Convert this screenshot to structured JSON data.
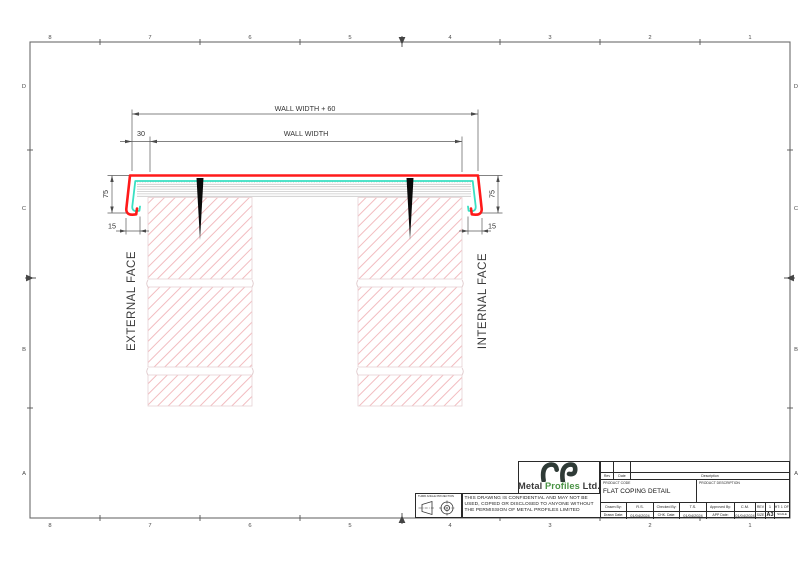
{
  "sheet": {
    "cols": [
      "8",
      "7",
      "6",
      "5",
      "4",
      "3",
      "2",
      "1"
    ],
    "rows": [
      "D",
      "C",
      "B",
      "A"
    ]
  },
  "drawing": {
    "dim_overall": "WALL WIDTH + 60",
    "dim_wall": "WALL WIDTH",
    "dim_overhang": "30",
    "dim_face_left": "75",
    "dim_face_right": "75",
    "dim_kick_left": "15",
    "dim_kick_right": "15",
    "label_external": "EXTERNAL FACE",
    "label_internal": "INTERNAL FACE",
    "colors": {
      "coping": "#ff1a1a",
      "membrane": "#38e0c3",
      "wall_hatch": "#f2bcc0"
    }
  },
  "title_block": {
    "rev_col": "Rev",
    "date_col": "Date",
    "description_col": "Description",
    "product_code_label": "PRODUCT CODE",
    "product_code_value": "FLAT COPING DETAIL",
    "product_description_label": "PRODUCT DESCRIPTION",
    "drawn_by_label": "Drawn By:",
    "drawn_by_value": "R.S.",
    "checked_by_label": "Checked By:",
    "checked_by_value": "T.S.",
    "approved_by_label": "Approved By:",
    "approved_by_value": "C.M.",
    "rev_label": "REV",
    "rev_value": "1",
    "sheet_no": "SHT: 1 OF 1",
    "drawn_date_label": "Drawn Date:",
    "drawn_date_value": "01/04/2024",
    "chk_date_label": "CHK. Date:",
    "chk_date_value": "01/04/2024",
    "app_date_label": "APP Date:",
    "app_date_value": "01/04/2024",
    "size_label": "SIZE",
    "size_value": "A3",
    "scale_label": "SCALE",
    "company_metal": "Metal",
    "company_profiles": "Profiles",
    "company_ltd": "Ltd.",
    "confidential_note": "THIS DRAWING IS CONFIDENTIAL AND MAY NOT BE USED, COPIED OR DISCLOSED TO ANYONE WITHOUT THE PERMISSION OF METAL PROFILES LIMITED",
    "projection_label": "THIRD ANGLE PROJECTION"
  }
}
